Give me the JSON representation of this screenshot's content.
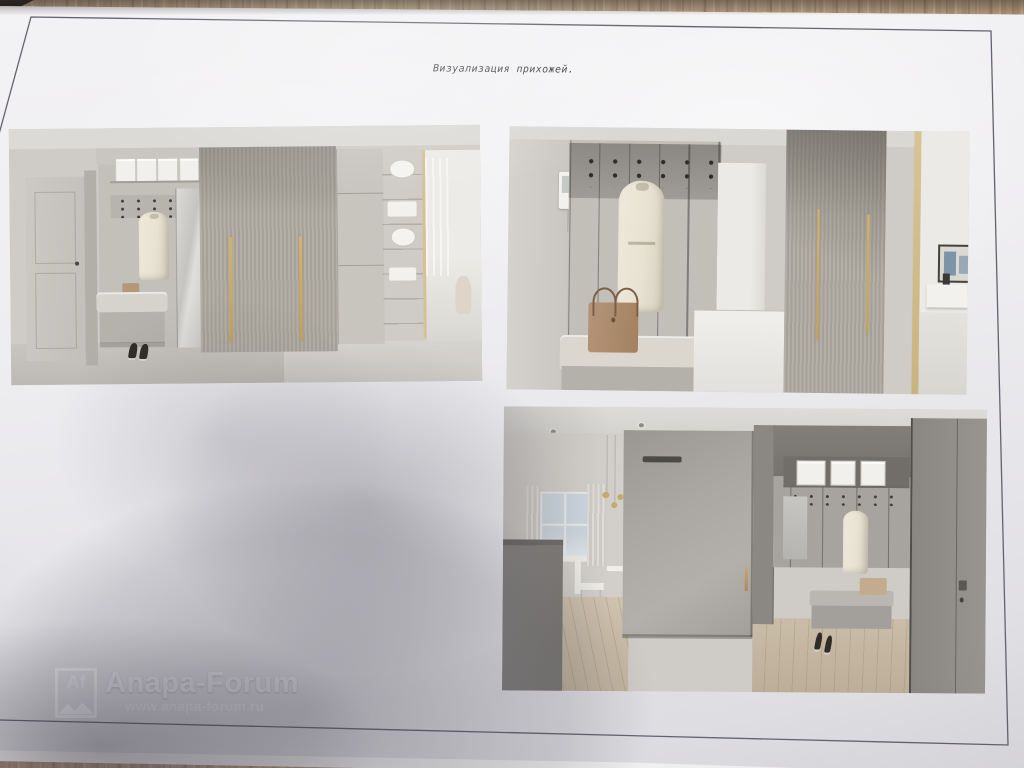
{
  "page": {
    "title": "Визуализация прихожей."
  },
  "watermark": {
    "badge_text": "Af",
    "brand": "Anapa-Forum",
    "url": "www.anapa-forum.ru"
  },
  "renders": [
    {
      "name": "hallway-elevation",
      "description": "Hallway wardrobe elevation: white entry door, niche with white storage boxes, hook panel with hanging cream coat, grey bench with basket and black shoes, ribbed sliding wardrobe with two brass handle strips, smooth cabinet, glass display cabinet with white dishes, bright room at right"
    },
    {
      "name": "coat-niche-view",
      "description": "Coat niche close view: intercom panel on left wall, dark hook band with black hooks, long hanging beige coat, bench cushion with tan handbag, white pedestal cabinet, ribbed wardrobe with brass strips and trim, bright corridor with framed picture and console"
    },
    {
      "name": "sliding-door-view",
      "description": "Hallway toward living room: kitchen island, window with sheer curtains, gold pendant lights, dining chair, grey sliding partition door with brass pull, mirror wardrobe niche with boxes, coat, bench and black heels, oak floor, grey door at right"
    }
  ],
  "colors": {
    "paper": "#ecebee",
    "frame_line": "#63636d",
    "wood_desk": "#b59c7e",
    "brass_accent": "#c9a96b",
    "coat_cream": "#e9e3d4",
    "shadow": "#97959c"
  }
}
